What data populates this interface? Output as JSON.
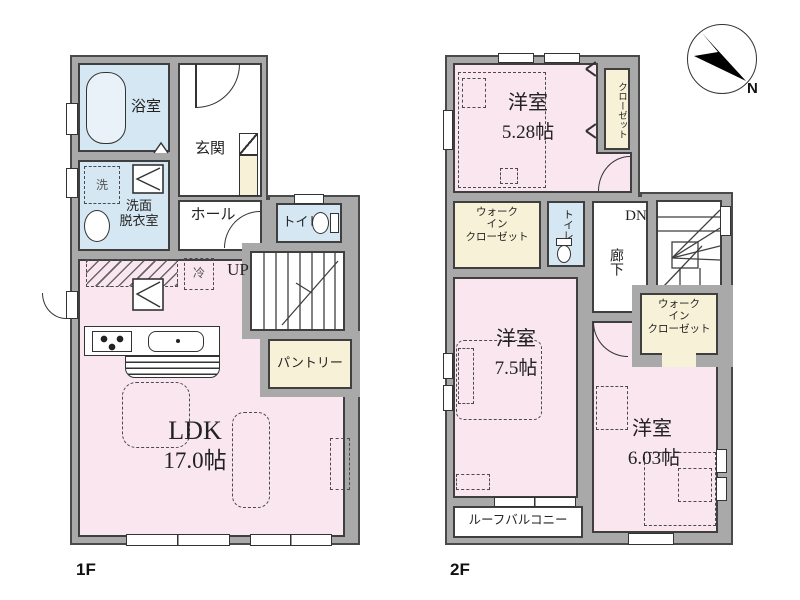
{
  "colors": {
    "wall_gray": "#a9a9a9",
    "line_dark": "#3f3f3f",
    "room_pink": "#f9e6ef",
    "wet_area_blue": "#d5e7f2",
    "storage_cream": "#f6f1d7"
  },
  "compass": {
    "north_label": "N"
  },
  "floor1": {
    "floor_label": "1F",
    "bath": {
      "label": "浴室"
    },
    "washroom": {
      "line1": "洗面",
      "line2": "脱衣室"
    },
    "washer": {
      "label": "洗"
    },
    "entrance": {
      "label": "玄関"
    },
    "hall": {
      "label": "ホール"
    },
    "toilet": {
      "label": "トイレ"
    },
    "stairs": {
      "label": "UP"
    },
    "fridge": {
      "label": "冷"
    },
    "pantry": {
      "label": "パントリー"
    },
    "ldk": {
      "label": "LDK",
      "area": "17.0帖"
    }
  },
  "floor2": {
    "floor_label": "2F",
    "bedroom1": {
      "label": "洋室",
      "area": "5.28帖"
    },
    "closet": {
      "label": "クローゼット"
    },
    "wic1": {
      "line1": "ウォーク",
      "line2": "イン",
      "line3": "クローゼット"
    },
    "toilet": {
      "label": "トイレ"
    },
    "hallway": {
      "label": "廊下"
    },
    "stairs": {
      "label": "DN"
    },
    "wic2": {
      "line1": "ウォーク",
      "line2": "イン",
      "line3": "クローゼット"
    },
    "bedroom2": {
      "label": "洋室",
      "area": "7.5帖"
    },
    "bedroom3": {
      "label": "洋室",
      "area": "6.03帖"
    },
    "balcony": {
      "label": "ルーフバルコニー"
    }
  }
}
